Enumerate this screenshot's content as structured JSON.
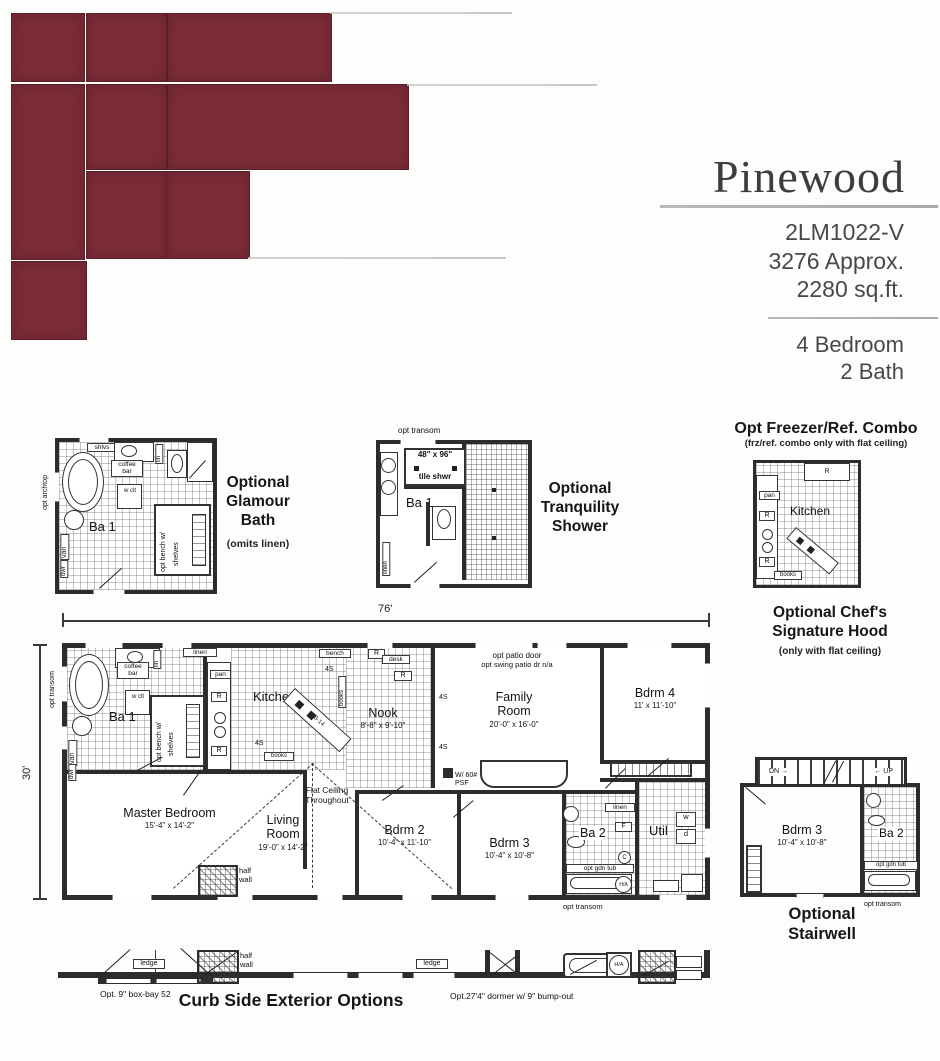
{
  "colors": {
    "maroon": "#7c2c37",
    "wall": "#2c2c2c"
  },
  "header": {
    "title": "Pinewood",
    "model": "2LM1022-V",
    "area1": "3276 Approx.",
    "area2": "2280 sq.ft.",
    "beds": "4 Bedroom",
    "baths": "2 Bath"
  },
  "shared": {
    "r": "R",
    "s4": "4S",
    "books": "books",
    "ba1": "Ba 1",
    "ba2": "Ba 2",
    "linen": "linen",
    "lin": "lin",
    "van": "van",
    "dwr": "dwr",
    "pan": "pan",
    "coffee_bar": "coffee bar",
    "w_clt": "w clt",
    "bench_w": "opt bench w/",
    "shelves": "shelves",
    "opt_transom": "opt transom",
    "opt_gdn_tub": "opt gdn tub",
    "half_wall": "half wall",
    "ledge": "ledge",
    "ha": "H/A"
  },
  "glamour": {
    "caption": "Optional Glamour Bath",
    "note": "(omits linen)",
    "shlvs": "shlvs",
    "opt_archtop": "opt archtop"
  },
  "tranquility": {
    "caption": "Optional Tranquility Shower",
    "size": "48\" x 96\"",
    "type": "tile shwr"
  },
  "freezer": {
    "title": "Opt Freezer/Ref. Combo",
    "subtitle": "(frz/ref. combo only with flat ceiling)",
    "kitchen": "Kitchen"
  },
  "hood": {
    "title": "Optional Chef's Signature Hood",
    "subtitle": "(only with flat ceiling)"
  },
  "main": {
    "dim_w": "76'",
    "dim_h": "30'",
    "bench": "bench",
    "desk": "desk",
    "patio1": "opt patio door",
    "patio2": "opt swing patio dr n/a",
    "kitchen": "Kitchen",
    "island": "ZB-14",
    "nook": "Nook",
    "nook_dim": "8'-8\" x 9'-10\"",
    "family": "Family Room",
    "family_dim": "20'-0\" x 16'-0\"",
    "bdrm4": "Bdrm 4",
    "bdrm4_dim": "11' x 11'-10\"",
    "master": "Master Bedroom",
    "master_dim": "15'-4\" x 14'-2\"",
    "living": "Living Room",
    "living_dim": "19'-0\" x 14'-2\"",
    "bdrm2": "Bdrm 2",
    "bdrm2_dim": "10'-4\" x 11'-10\"",
    "bdrm3": "Bdrm 3",
    "bdrm3_dim": "10'-4\" x 10'-8\"",
    "util": "Util",
    "w": "w",
    "d": "d",
    "f": "F",
    "c": "C",
    "psf": "W/ 60# PSF",
    "flat": "Flat Ceiling Throughout"
  },
  "stairwell": {
    "caption": "Optional Stairwell",
    "dn": "DN →",
    "up": "← UP",
    "bdrm3": "Bdrm 3",
    "dim": "10'-4\" x 10'-8\""
  },
  "curb": {
    "title": "Curb Side Exterior Options",
    "left_caption": "Opt. 9\" box-bay 52",
    "right_caption": "Opt.27'4\" dormer w/ 9\" bump-out"
  }
}
